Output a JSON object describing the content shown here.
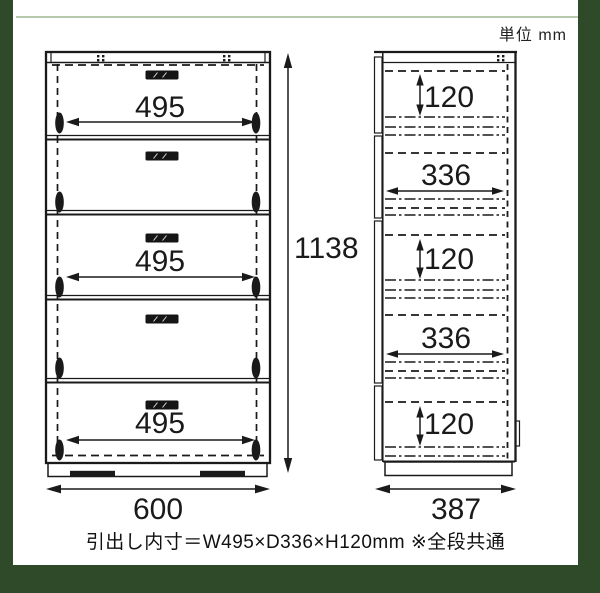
{
  "unit_label": "単位 mm",
  "footer_note": "引出し内寸＝W495×D336×H120mm ※全段共通",
  "front_view": {
    "overall_width": "600",
    "overall_height": "1138",
    "drawer_inner_width": "495"
  },
  "side_view": {
    "overall_depth": "387",
    "drawer_inner_depth": "336",
    "drawer_inner_height": "120"
  },
  "colors": {
    "frame_green": "#2f4a28",
    "top_rule_green": "#b7c9ac",
    "ink": "#1a1a1a",
    "paper": "#ffffff"
  }
}
